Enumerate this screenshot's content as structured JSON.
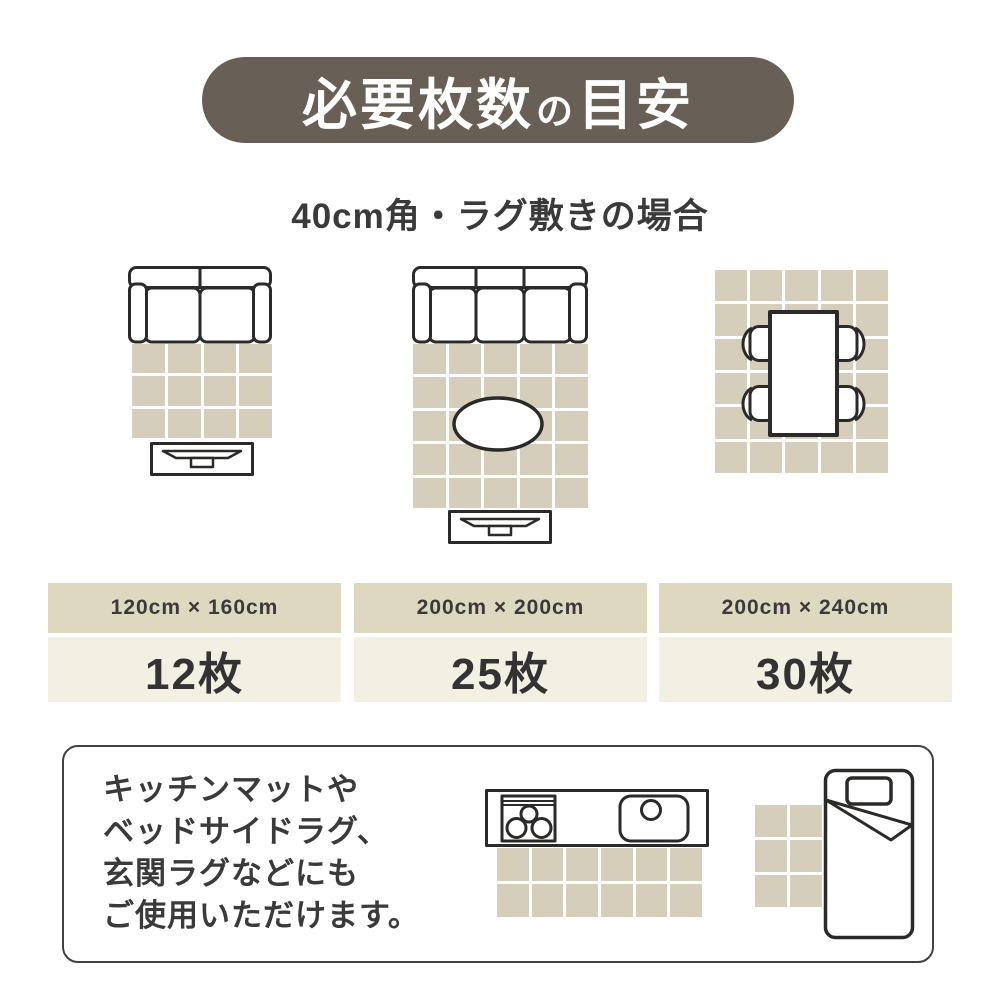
{
  "header": {
    "title_parts": [
      "必要枚数",
      "の",
      "目安"
    ]
  },
  "subtitle": "40cm角・ラグ敷きの場合",
  "colors": {
    "banner_bg": "#686056",
    "banner_text": "#ffffff",
    "tile": "#d5cebb",
    "grid_gap": "#ffffff",
    "size_cell_bg": "#ded8c0",
    "count_cell_bg": "#f2f0e3",
    "text": "#3a3a3a",
    "outline": "#2b2a28"
  },
  "diagrams": [
    {
      "icon": "sofa-2seat-with-rug-and-tv-board",
      "size": "120cm × 160cm",
      "count": "12枚",
      "grid": {
        "cols": 4,
        "rows": 3
      }
    },
    {
      "icon": "sofa-3seat-with-low-table-and-tv-board",
      "size": "200cm × 200cm",
      "count": "25枚",
      "grid": {
        "cols": 5,
        "rows": 5
      }
    },
    {
      "icon": "dining-table-with-four-chairs",
      "size": "200cm × 240cm",
      "count": "30枚",
      "grid": {
        "cols": 5,
        "rows": 6
      }
    }
  ],
  "note": {
    "lines": [
      "キッチンマットや",
      "ベッドサイドラグ、",
      "玄関ラグなどにも",
      "ご使用いただけます。"
    ],
    "kitchen_mat_grid": {
      "cols": 6,
      "rows": 2
    },
    "bedside_mat_grid": {
      "cols": 2,
      "rows": 3
    }
  }
}
